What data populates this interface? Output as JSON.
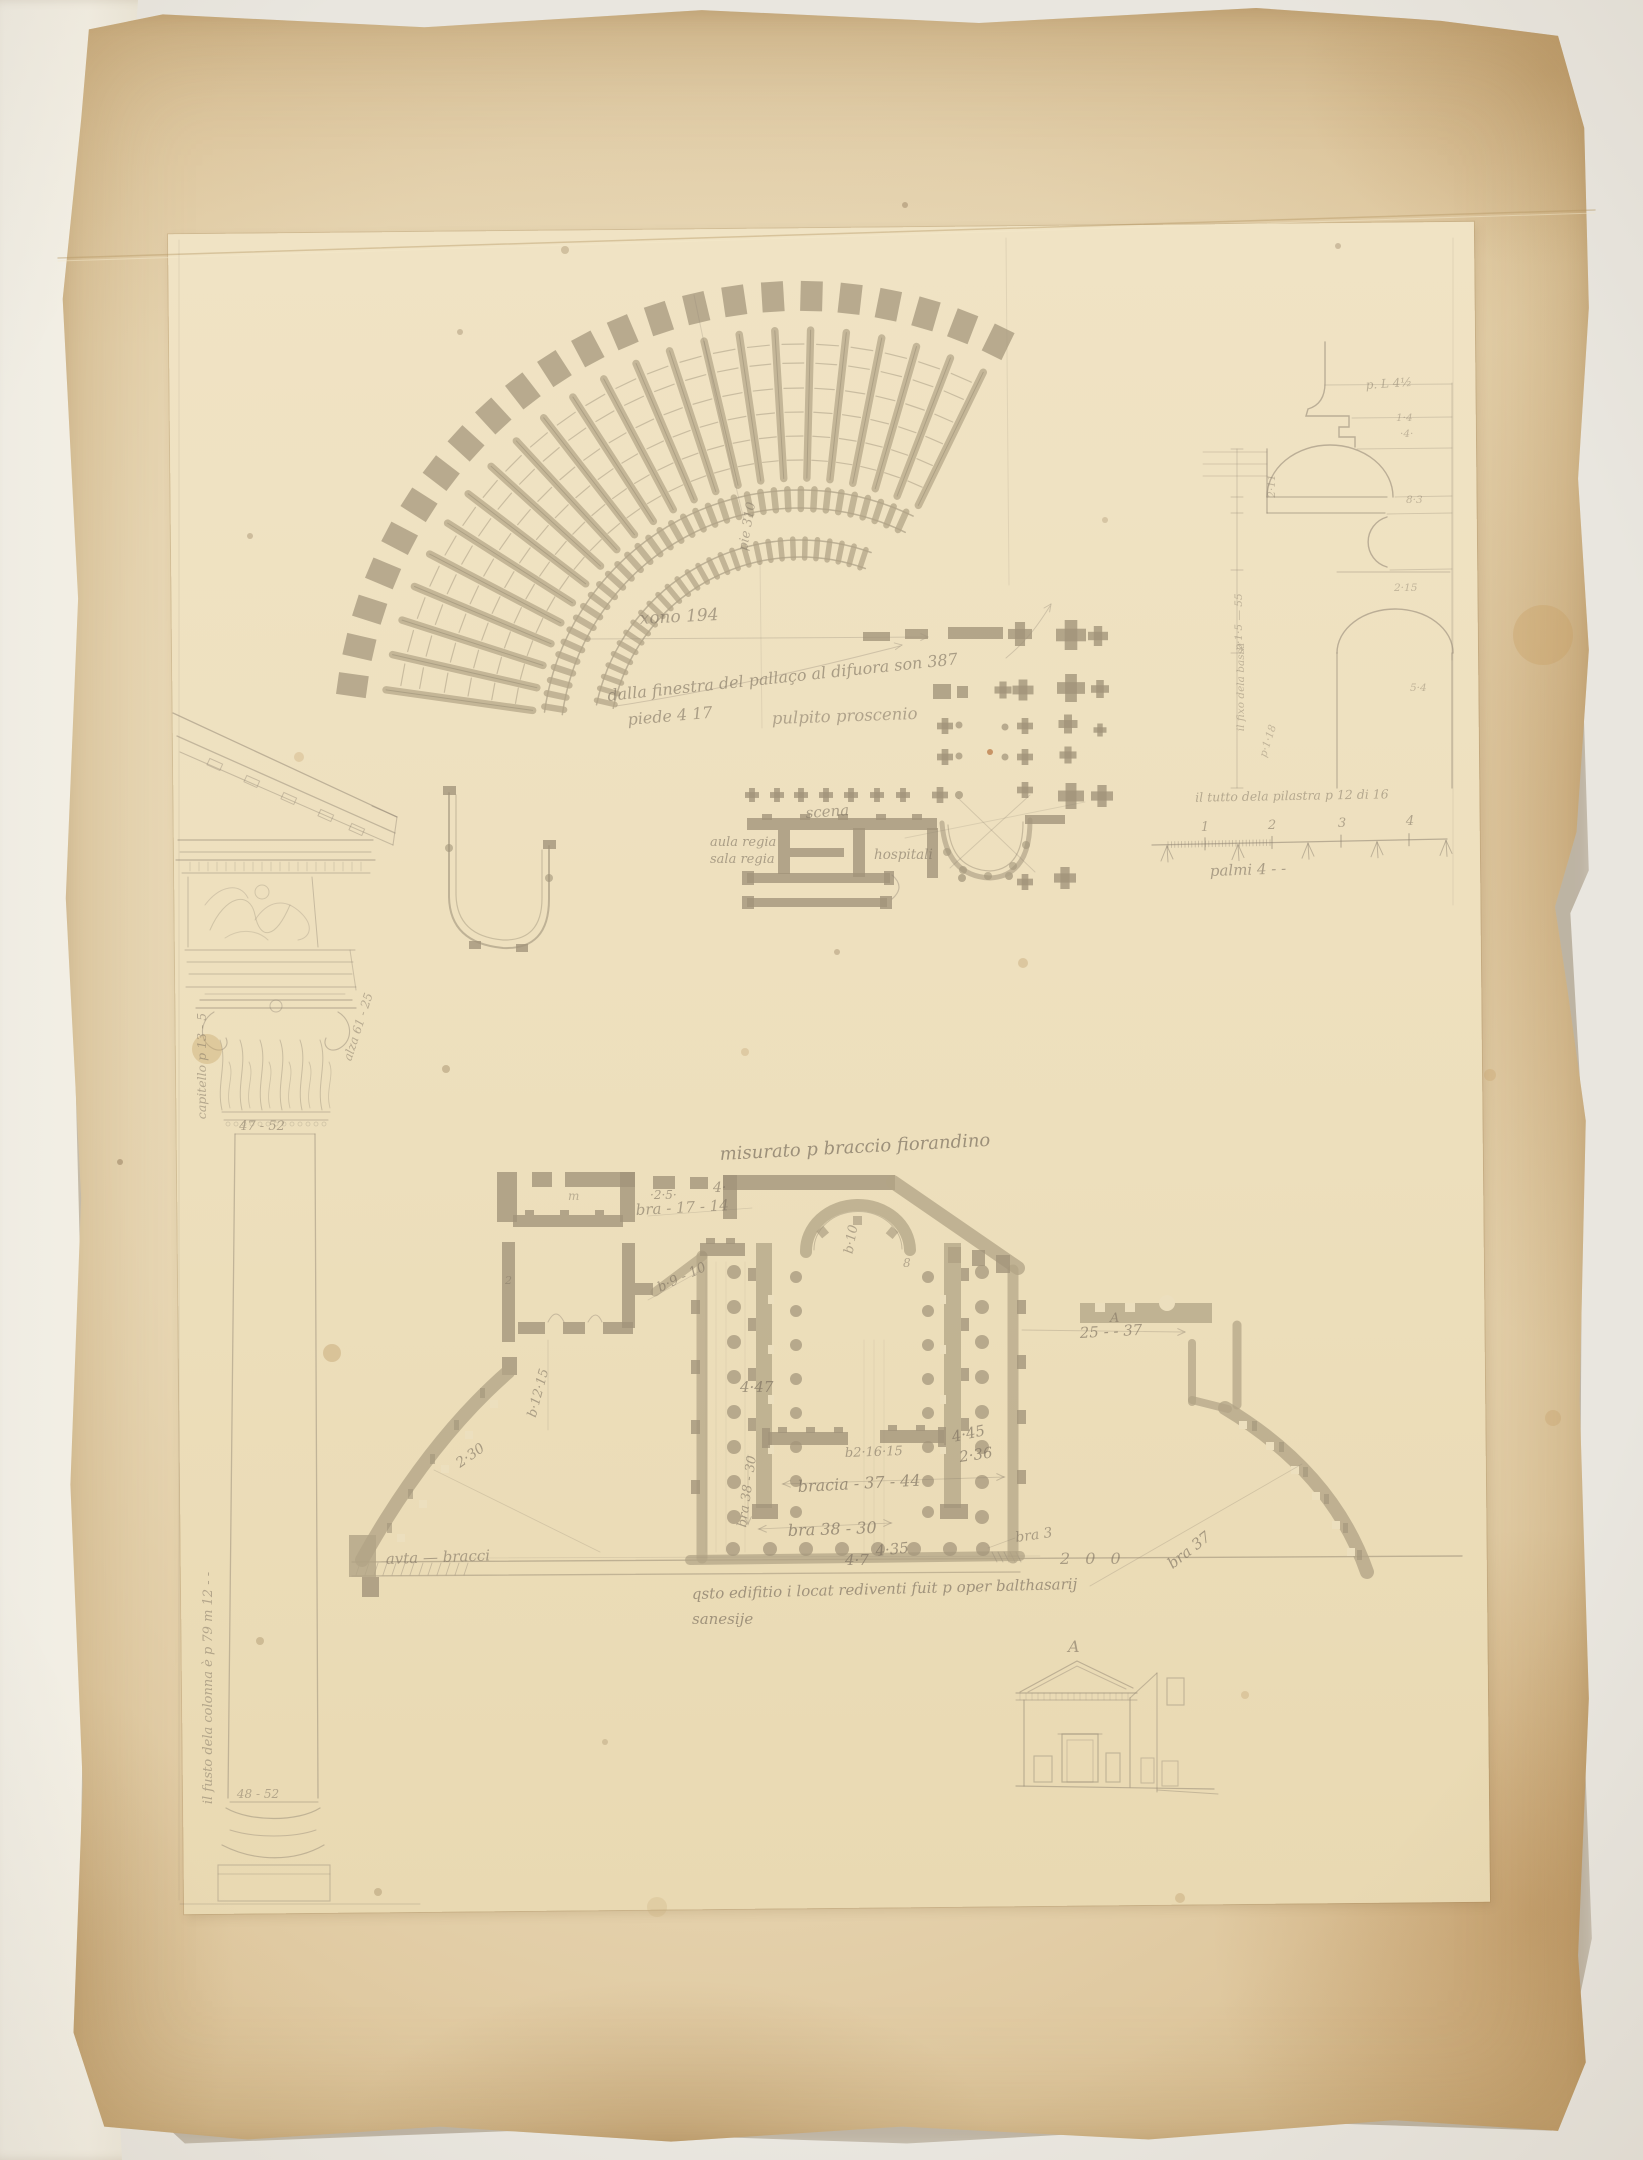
{
  "palette": {
    "paper": "#e6d5b2",
    "inner_sheet": "#eee1c0",
    "graphite": "#8a7f6e",
    "wash": "#b2a486",
    "pier": "#a2947a"
  },
  "annotations": {
    "theater": {
      "pie310": "pie 310",
      "xono": "xono 194",
      "finestra": "dalla finestra del pallaço al difuora son 387",
      "piede": "piede 4 17",
      "pulpito": "pulpito  proscenio"
    },
    "scaena": {
      "scena": "scena",
      "aula": "aula regia",
      "sala": "sala regia",
      "hospitali": "hospitali"
    },
    "profile": {
      "top": "p. L 4½",
      "n1": "1·4",
      "n2": "·4·",
      "n3": "8·3",
      "n4": "2·15",
      "n5": "5·4",
      "left1": "p·1·5 — 55",
      "left2": "il fixo dela bassa",
      "left3": "p·1·18",
      "left4": "2·11",
      "caption": "il tutto dela pilastra p 12 di 16"
    },
    "scalebar": {
      "t1": "1",
      "t2": "2",
      "t3": "3",
      "t4": "4",
      "label": "palmi 4 - -"
    },
    "column": {
      "capitello": "capitello p 13 - 5",
      "alza": "alza 61 - 25",
      "cap_w": "47 - 52",
      "fusto": "il fusto dela colonna è p 79 m 12 - -",
      "base_w": "48 - 52"
    },
    "plan": {
      "misurato": "misurato p braccio fiorandino",
      "bra1714": "bra - 17 - 14",
      "n25": "·2·5·",
      "n4": "4·",
      "b910": "b·9 - 10",
      "b1215": "b·12·15",
      "n230": "2·30",
      "m": "m",
      "n2": "2",
      "b10": "b·10",
      "n8": "8",
      "n447": "4·47",
      "n445": "4·45",
      "n236": "2·36",
      "b21615": "b2·16·15",
      "bracia": "bracia - 37 - 44",
      "bra3830v": "bra 38 - 30",
      "bra3830h": "bra 38 - 30",
      "n47": "4·7",
      "n435": "4·35",
      "bra3": "bra 3",
      "n200": "2 0 0",
      "a1": "A",
      "bra2537": "25 - - 37",
      "bra37": "bra 37",
      "avta": "avta — bracci",
      "colo1": "qsto edifitio i locat rediventi fuit p oper balthasarij",
      "colo2": "sanesije"
    },
    "section": {
      "a": "A"
    }
  }
}
